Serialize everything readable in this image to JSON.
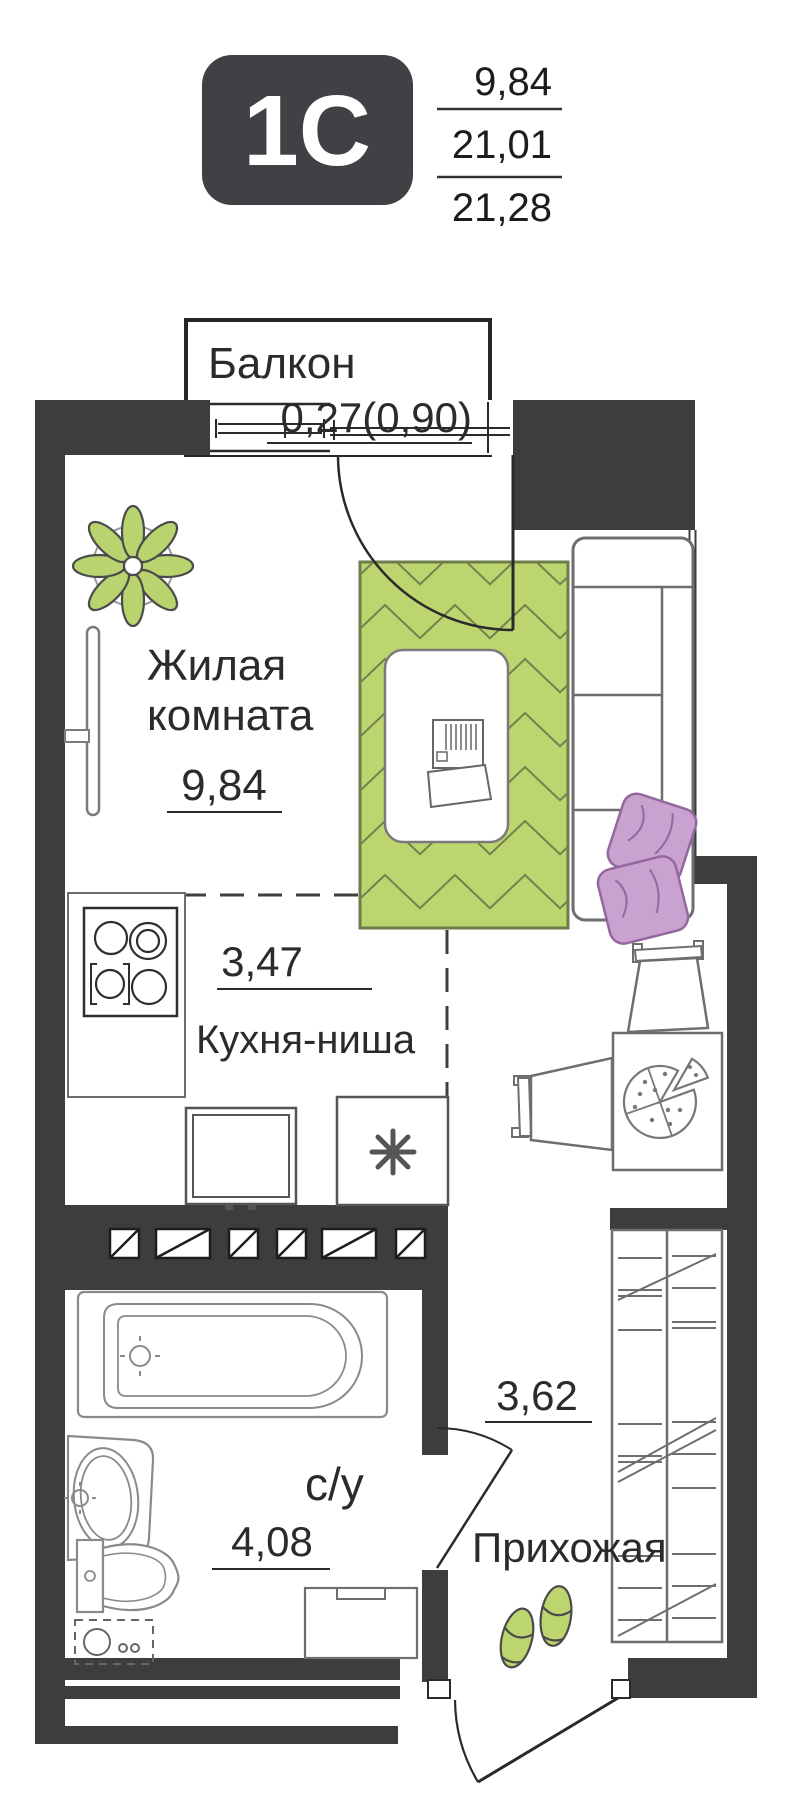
{
  "header": {
    "badge": "1C",
    "area_living": "9,84",
    "area_no_balcony": "21,01",
    "area_total": "21,28"
  },
  "rooms": {
    "balcony": {
      "label": "Балкон",
      "area": "0,27(0,90)"
    },
    "living": {
      "label_line1": "Жилая",
      "label_line2": "комната",
      "area": "9,84"
    },
    "kitchen": {
      "label": "Кухня-ниша",
      "area": "3,47"
    },
    "bathroom": {
      "label": "с/у",
      "area": "4,08"
    },
    "hallway": {
      "label": "Прихожая",
      "area": "3,62"
    }
  },
  "colors": {
    "wall": "#3d3d40",
    "accent_green": "#bcd56f",
    "pillow_purple": "#c9a2cf",
    "badge_bg": "#414044"
  }
}
